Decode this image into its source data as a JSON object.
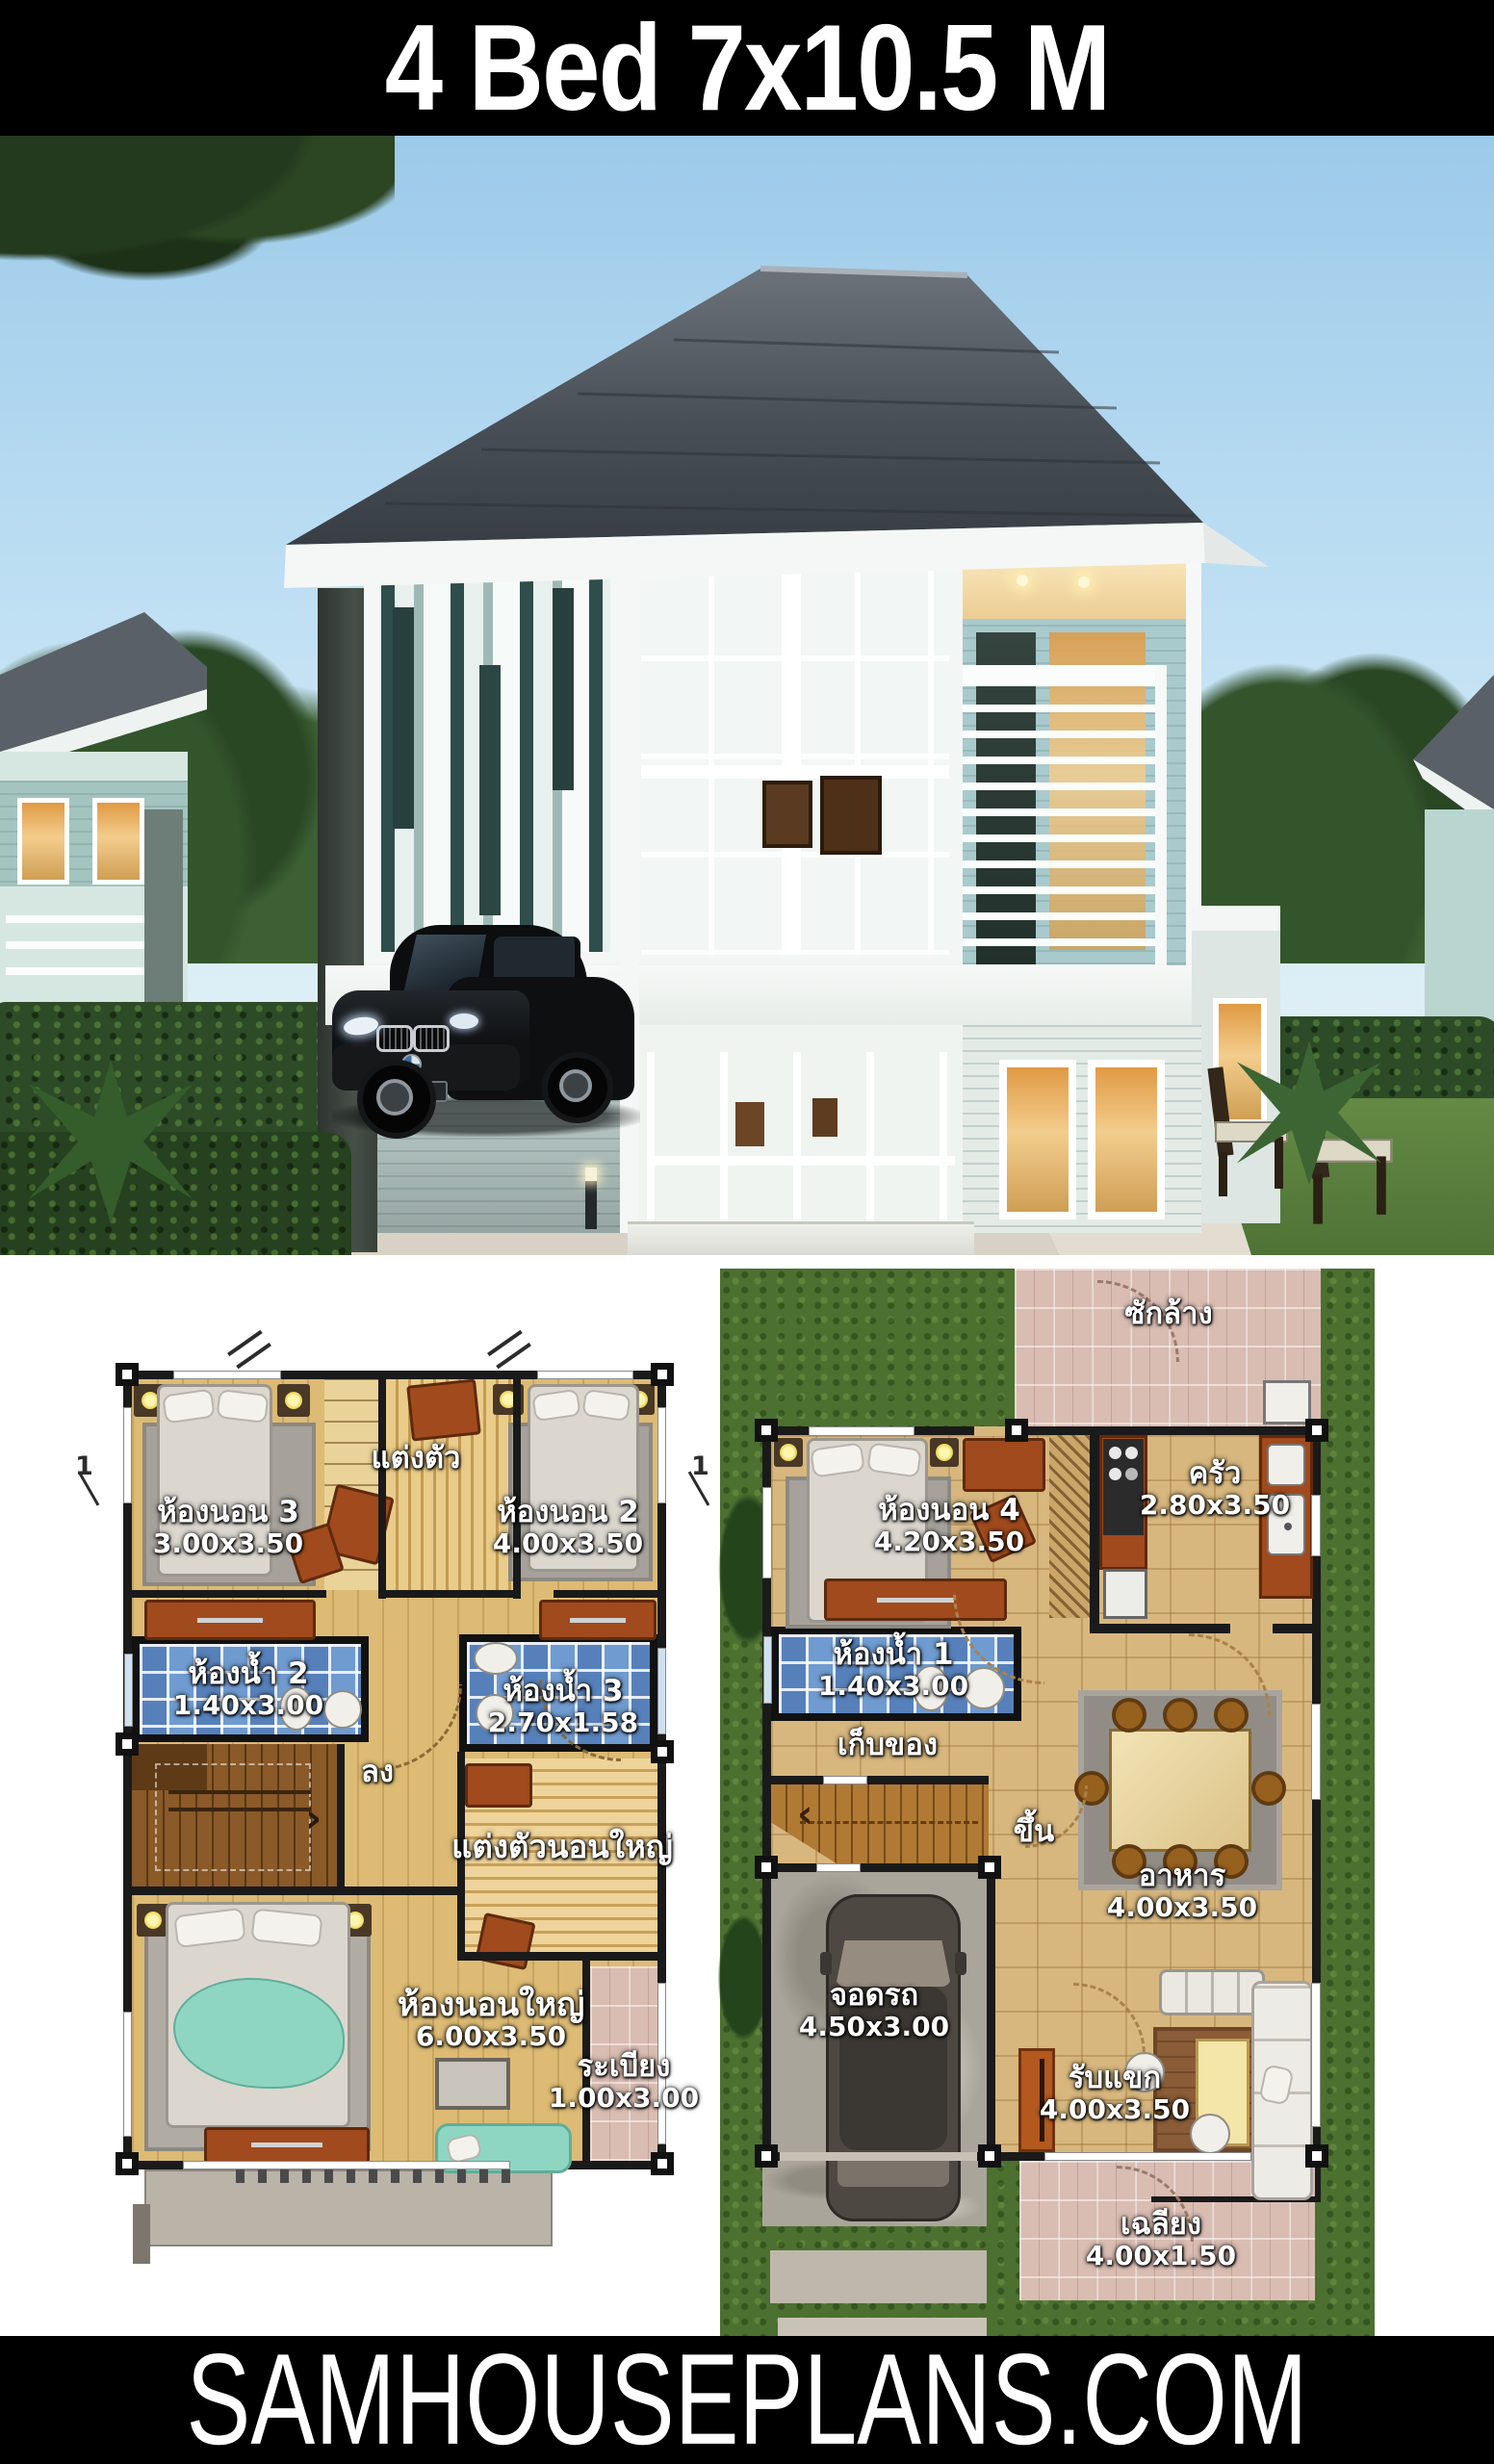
{
  "header": {
    "title": "4 Bed 7x10.5 M"
  },
  "photo": {
    "watermark": "SAMHOUSEPLANS.COM"
  },
  "footer": {
    "brand": "SAMHOUSEPLANS.COM"
  },
  "floor2": {
    "section_marker": "1",
    "stair_label": "ลง",
    "stair_arrow": "›",
    "rooms": {
      "bedroom3": {
        "name": "ห้องนอน 3",
        "dim": "3.00x3.50"
      },
      "dressing": {
        "name": "แต่งตัว"
      },
      "bedroom2": {
        "name": "ห้องนอน 2",
        "dim": "4.00x3.50"
      },
      "bath2": {
        "name": "ห้องน้ำ 2",
        "dim": "1.40x3.00"
      },
      "bath3": {
        "name": "ห้องน้ำ 3",
        "dim": "2.70x1.58"
      },
      "master_dressing": {
        "name": "แต่งตัวนอนใหญ่"
      },
      "master_bedroom": {
        "name": "ห้องนอนใหญ่",
        "dim": "6.00x3.50"
      },
      "balcony": {
        "name": "ระเบียง",
        "dim": "1.00x3.00"
      }
    }
  },
  "floor1": {
    "stair_label": "ขึ้น",
    "stair_arrow": "‹",
    "rooms": {
      "laundry": {
        "name": "ซักล้าง"
      },
      "bedroom4": {
        "name": "ห้องนอน 4",
        "dim": "4.20x3.50"
      },
      "kitchen": {
        "name": "ครัว",
        "dim": "2.80x3.50"
      },
      "bath1": {
        "name": "ห้องน้ำ 1",
        "dim": "1.40x3.00"
      },
      "storage": {
        "name": "เก็บของ"
      },
      "dining": {
        "name": "อาหาร",
        "dim": "4.00x3.50"
      },
      "carpark": {
        "name": "จอดรถ",
        "dim": "4.50x3.00"
      },
      "living": {
        "name": "รับแขก",
        "dim": "4.00x3.50"
      },
      "porch": {
        "name": "เฉลียง",
        "dim": "4.00x1.50"
      }
    }
  },
  "colors": {
    "banner_bg": "#000000",
    "banner_text": "#ffffff",
    "roof": "#454c54",
    "fascia": "#f4f7f5",
    "wall_teal": "#a9cacd",
    "warm_window": "#e8a84e",
    "hedge": "#2d4b27",
    "lawn_photo": "#5d8140",
    "plan_wood": "#ddbb74",
    "plan_tile": "#d7b77e",
    "bath_blue": "#6f9bd0",
    "plan_lawn": "#4c7030",
    "pink_tile": "#d9bcb2",
    "wall": "#1a1a1a",
    "furniture_brown": "#a04a1d"
  }
}
